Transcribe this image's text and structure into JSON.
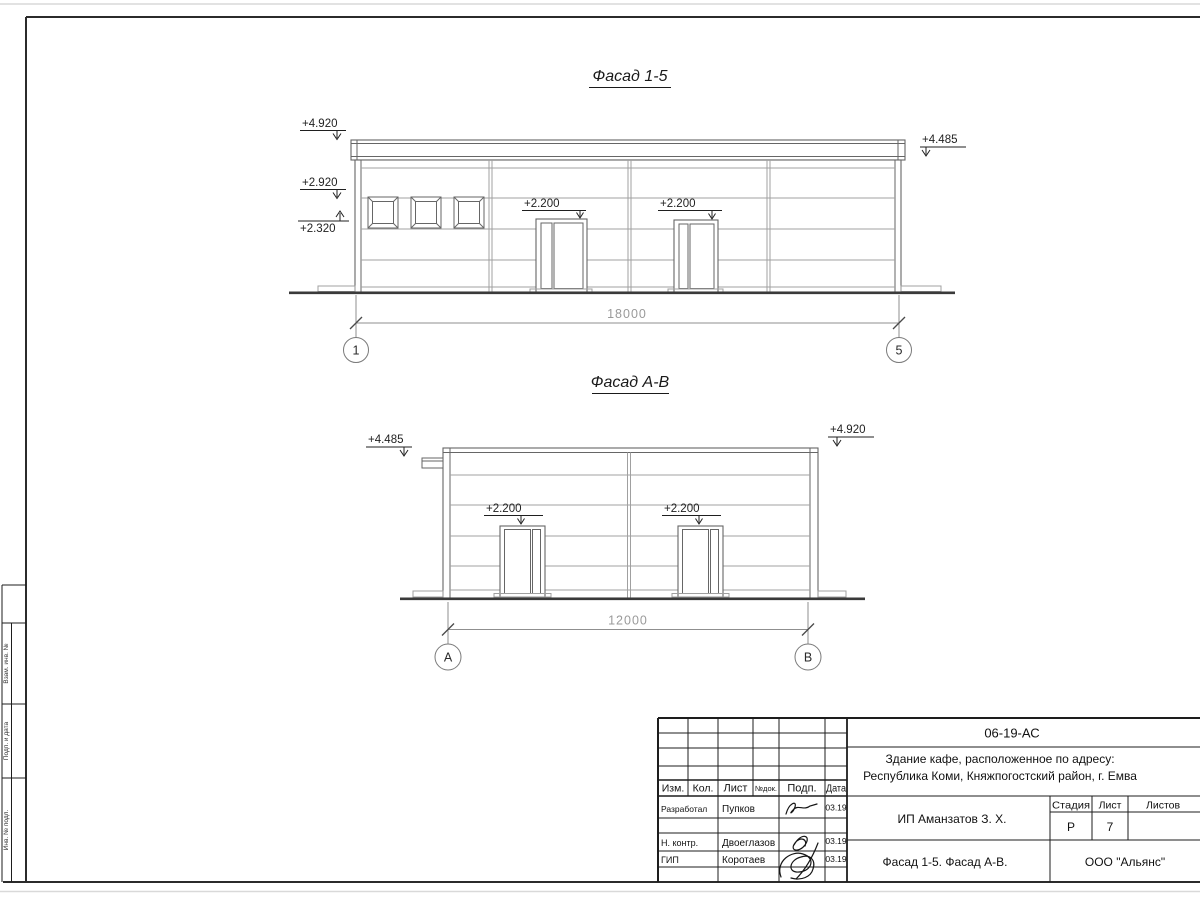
{
  "colors": {
    "ink": "#2b2b2b",
    "dim_text": "#9a9a9a",
    "light_line": "#a0a0a0"
  },
  "facade_15": {
    "title": "Фасад 1-5",
    "mark_top_left": "+4.920",
    "mark_mid_left": "+2.920",
    "mark_low_left": "+2.320",
    "mark_top_right": "+4.485",
    "mark_door1": "+2.200",
    "mark_door2": "+2.200",
    "dimension": "18000",
    "axis_left": "1",
    "axis_right": "5"
  },
  "facade_ab": {
    "title": "Фасад А-В",
    "mark_top_left": "+4.485",
    "mark_top_right": "+4.920",
    "mark_door1": "+2.200",
    "mark_door2": "+2.200",
    "dimension": "12000",
    "axis_left": "А",
    "axis_right": "В"
  },
  "side_column": {
    "cell_top": "Взам. инв. №",
    "cell_middle": "Подп. и дата",
    "cell_bottom": "Инв. № подл."
  },
  "title_block": {
    "doc_number": "06-19-АС",
    "project_line1": "Здание кафе, расположенное по адресу:",
    "project_line2": "Республика Коми, Княжпогостский район, г. Емва",
    "client": "ИП Аманзатов З. Х.",
    "sheet_title": "Фасад 1-5. Фасад А-В.",
    "company": "ООО \"Альянс\"",
    "col_izm": "Изм.",
    "col_kol": "Кол.",
    "col_list": "Лист",
    "col_ndok": "№док.",
    "col_podp": "Подп.",
    "col_data": "Дата",
    "stage_label": "Стадия",
    "list_label": "Лист",
    "listov_label": "Листов",
    "stage_value": "Р",
    "list_value": "7",
    "rows": [
      {
        "role": "Разработал",
        "name": "Пупков",
        "date": "03.19"
      },
      {
        "role": "Н. контр.",
        "name": "Двоеглазов",
        "date": "03.19"
      },
      {
        "role": "ГИП",
        "name": "Коротаев",
        "date": "03.19"
      }
    ]
  }
}
